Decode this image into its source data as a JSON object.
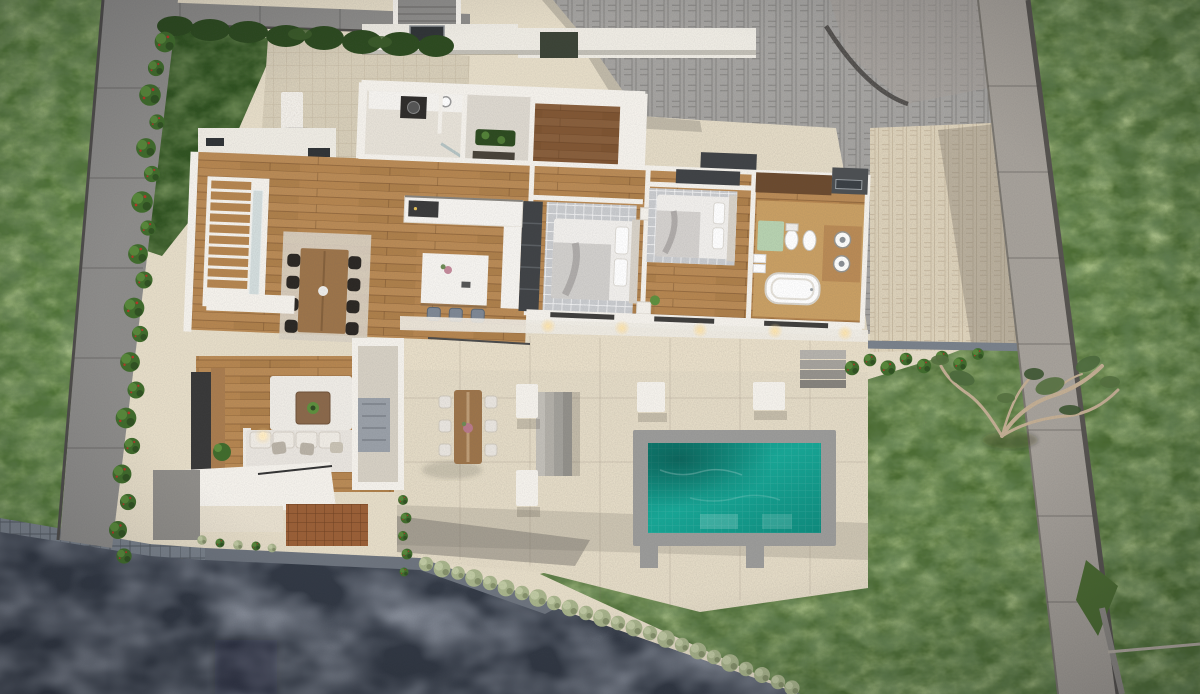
{
  "scene": {
    "type": "3d-architectural-render",
    "view": "top-down-aerial",
    "subject": "single-storey modern villa with pool, cutaway roof floor plan",
    "lighting": "dusk with warm interior downlights"
  },
  "palette": {
    "lawn-west": "#507635",
    "lawn-east": "#4b6c31",
    "lawn-shade": "#2f5220",
    "grass-light": "#93b060",
    "wall-gray": "#8d8c8a",
    "wall-light": "#a6a19a",
    "wall-edge": "#4e4c4a",
    "driveway": "#a4a3a1",
    "court": "#d9d0ba",
    "patio": "#e6ddc8",
    "patio-east": "#ded3bb",
    "road": "#323945",
    "road-light": "#4a5160",
    "curb": "#79818b",
    "white-wall": "#f5f2ec",
    "roof-white": "#efece4",
    "roof-dark": "#3b4336",
    "wood-floor": "#b5854f",
    "wood-foyer": "#815633",
    "deck-wood": "#9a5f36",
    "rug-gray": "#c9cbce",
    "rug-cream": "#d9d2c4",
    "rug-white": "#efece6",
    "sofa": "#e9e5df",
    "cushion": "#b9b2a6",
    "tv-panel": "#383838",
    "table-wood": "#9c744a",
    "chair-black": "#2b2723",
    "stool-blue": "#7d8794",
    "island": "#f6f4f0",
    "bed-white": "#f1efec",
    "blanket": "#c9c7c4",
    "wardrobe": "#3f4245",
    "cabinet-brown": "#6b4a2e",
    "bath-mat": "#b7d2b0",
    "vanity-wood": "#b98a55",
    "pool-frame": "#9b9b99",
    "pool-water-light": "#1aa897",
    "pool-water-deep": "#0c8a7c",
    "bush": "#3f6b2b",
    "bush-light": "#5d8f3d",
    "hedge-dark": "#2c4a1f",
    "hedge-pale": "#a8b48b",
    "flower-red": "#b43527",
    "glow-warm": "#ffdf9e"
  },
  "site": {
    "areas": [
      {
        "name": "west-lawn"
      },
      {
        "name": "east-lawn"
      },
      {
        "name": "shaded-lawn-strip"
      },
      {
        "name": "entry-court"
      },
      {
        "name": "paver-driveway"
      },
      {
        "name": "east-patio"
      },
      {
        "name": "pool-terrace"
      },
      {
        "name": "asphalt-road"
      },
      {
        "name": "timber-sun-deck"
      },
      {
        "name": "boundary-wall-west"
      },
      {
        "name": "boundary-wall-east"
      },
      {
        "name": "boundary-wall-north"
      },
      {
        "name": "shrub-row-west"
      },
      {
        "name": "hedge-along-road"
      },
      {
        "name": "hedge-north"
      },
      {
        "name": "olive-tree"
      }
    ]
  },
  "house": {
    "floors_visible": 1,
    "rooms": [
      {
        "name": "laundry",
        "items": [
          "counter",
          "washer",
          "sink"
        ]
      },
      {
        "name": "entry-hall",
        "items": [
          "planter",
          "doormat"
        ]
      },
      {
        "name": "foyer",
        "items": [
          "dark-wood-floor"
        ]
      },
      {
        "name": "corridor",
        "items": []
      },
      {
        "name": "kitchen",
        "items": [
          "island",
          "3 stools",
          "cooktop",
          "tall-units"
        ]
      },
      {
        "name": "dining-area",
        "items": [
          "wood-table",
          "8 black chairs",
          "area-rug"
        ]
      },
      {
        "name": "staircase",
        "items": [
          "timber-treads",
          "glass-balustrade"
        ]
      },
      {
        "name": "living-room",
        "items": [
          "sofa",
          "tv-wall",
          "coffee-table",
          "rug",
          "floor-lamp",
          "plant"
        ]
      },
      {
        "name": "mudroom",
        "items": [
          "lockers"
        ]
      },
      {
        "name": "bedroom-1",
        "items": [
          "double-bed",
          "grid-rug",
          "wardrobe",
          "nightstands"
        ]
      },
      {
        "name": "bedroom-2",
        "items": [
          "double-bed",
          "grid-rug",
          "wardrobe"
        ]
      },
      {
        "name": "bathroom",
        "items": [
          "freestanding-tub",
          "double-vanity",
          "toilet",
          "bidet",
          "green-mat",
          "towels"
        ]
      }
    ]
  },
  "outdoor": {
    "pool": {
      "shape": "rectangle",
      "water": "turquoise",
      "coping": "gray-concrete"
    },
    "outdoor_dining": {
      "table": "timber",
      "chairs": 6,
      "centerpiece": "flowers"
    },
    "terrace_steps": 2,
    "planter_boxes": 4,
    "exterior_stair_north": true,
    "roof_elements": [
      "white-parapet-slabs",
      "skylight",
      "roof-garden-patch"
    ]
  }
}
